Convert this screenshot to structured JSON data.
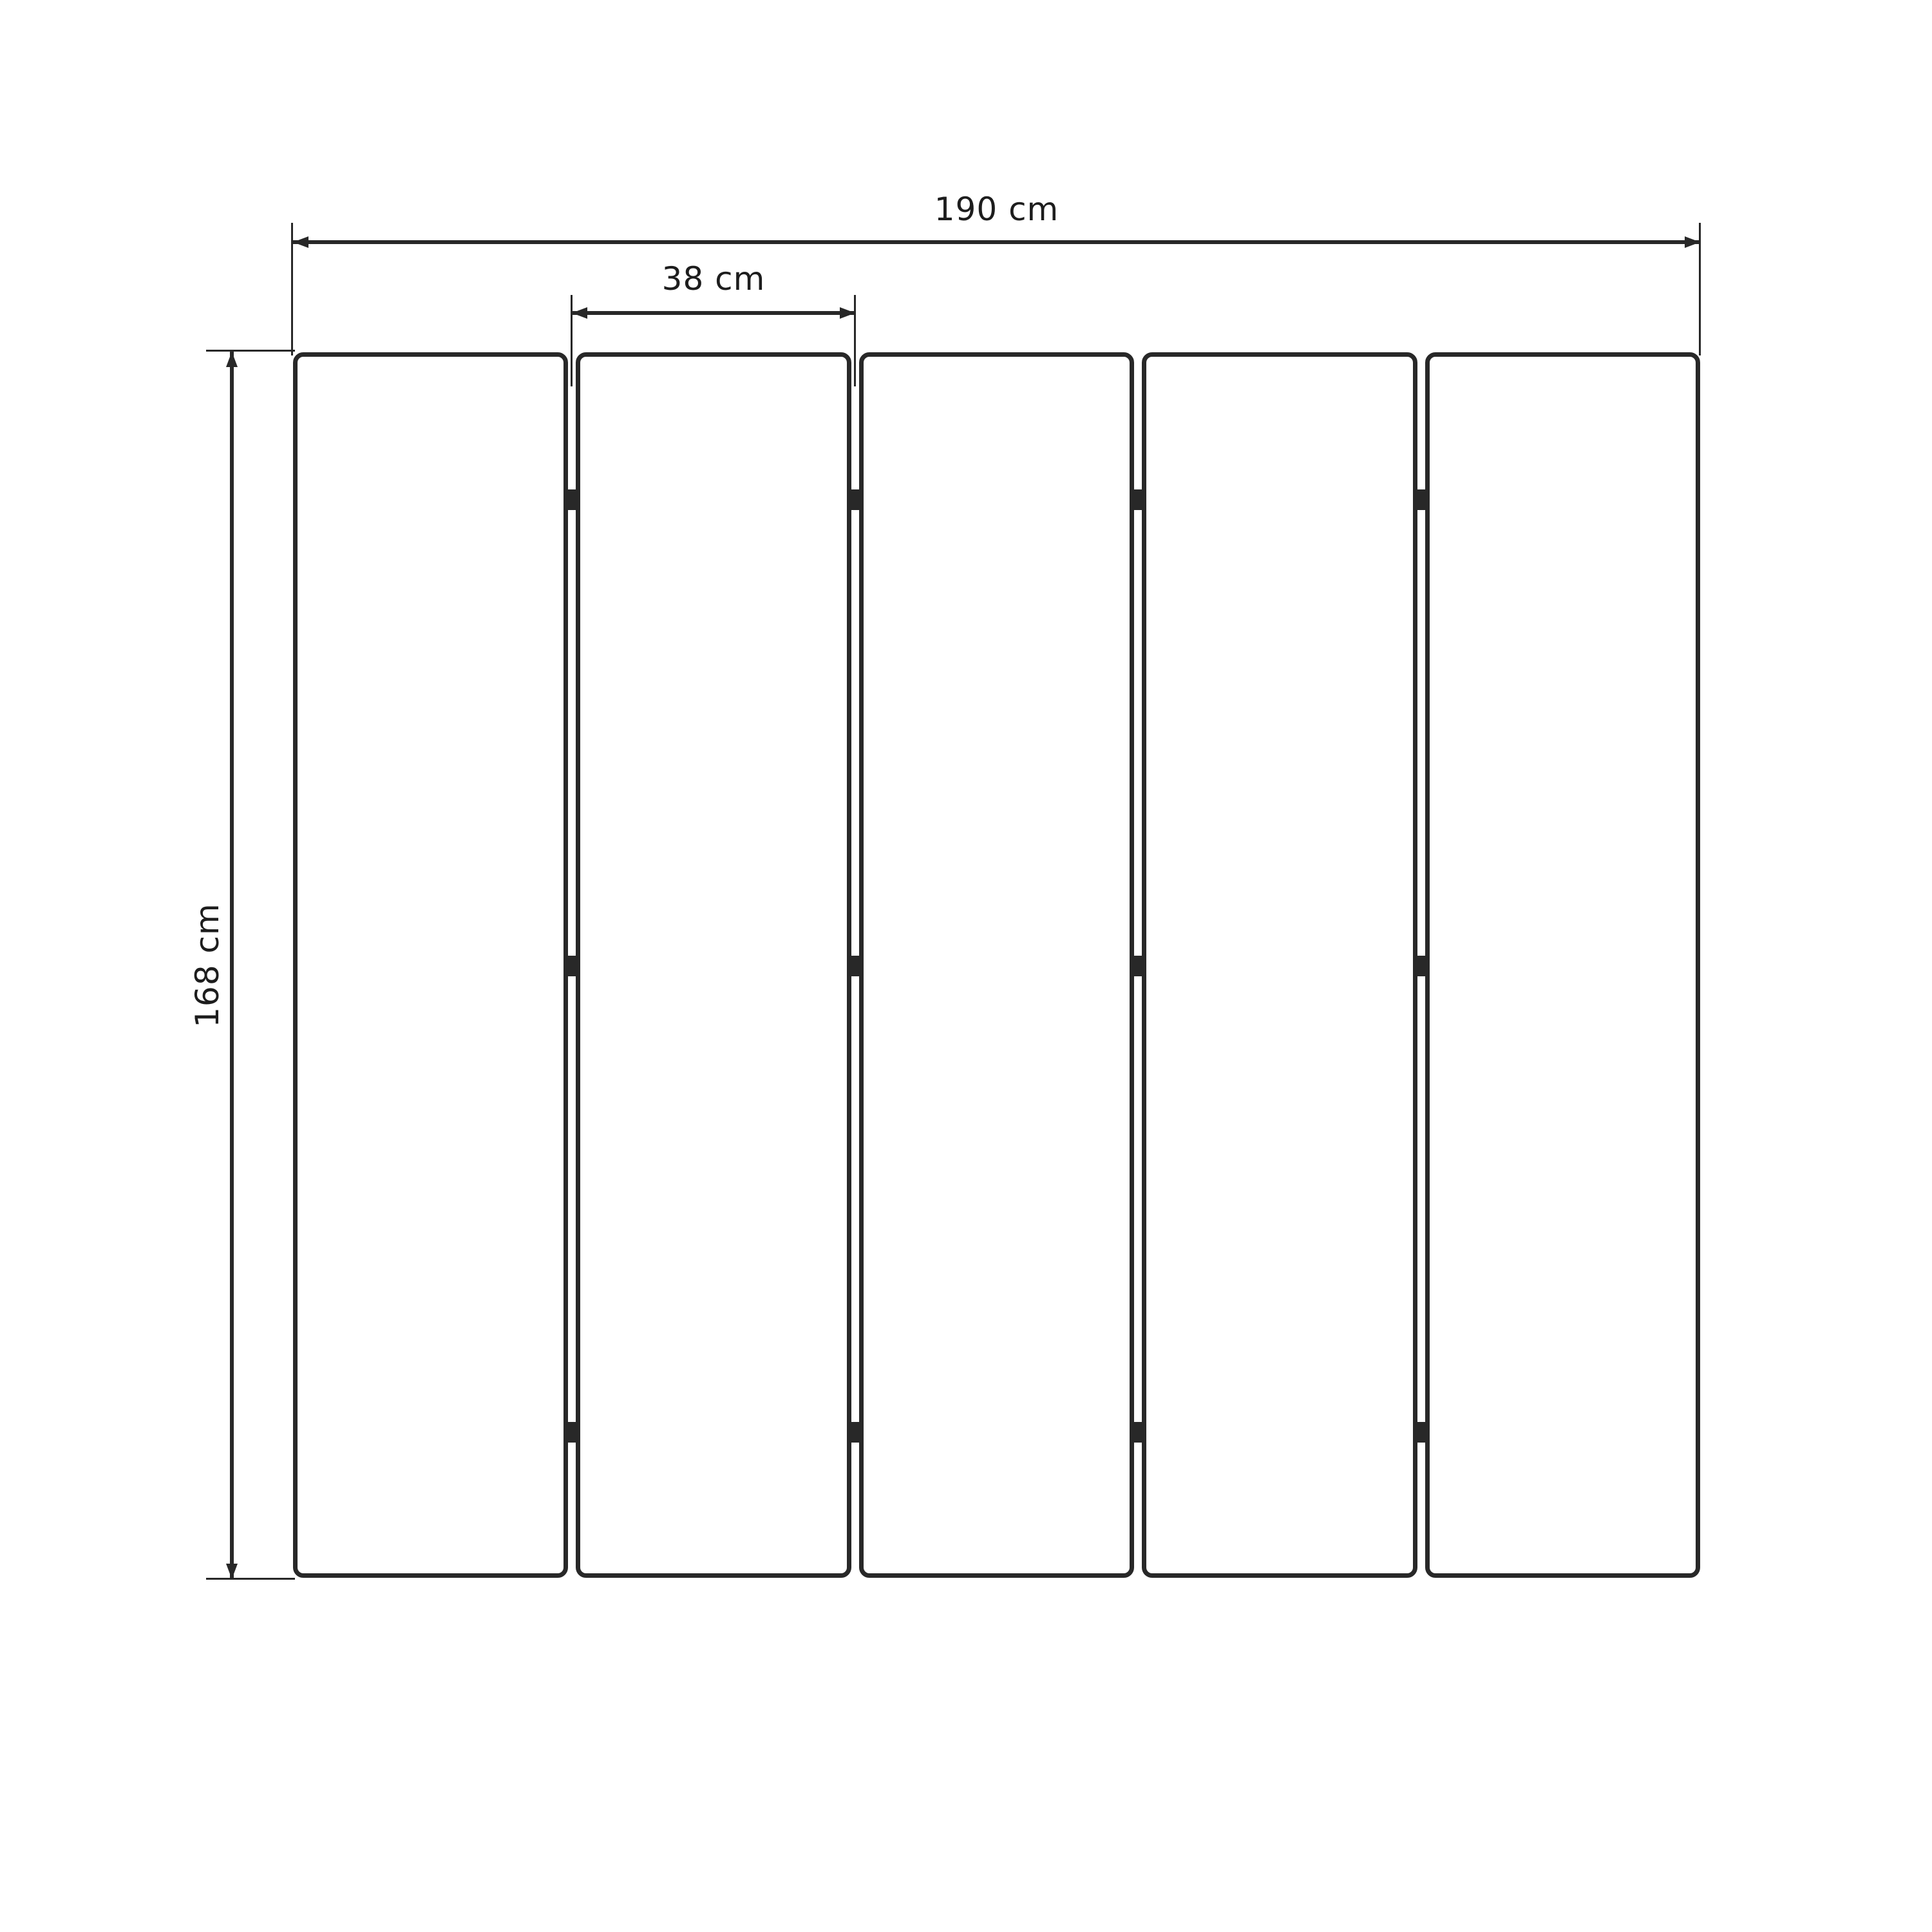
{
  "diagram": {
    "dimensions": {
      "total_width": {
        "label": "190 cm",
        "value": 190,
        "unit": "cm"
      },
      "panel_width": {
        "label": "38 cm",
        "value": 38,
        "unit": "cm"
      },
      "height": {
        "label": "168 cm",
        "value": 168,
        "unit": "cm"
      }
    },
    "panels": {
      "count": 5,
      "gaps": 4,
      "hinges_per_gap": 3
    }
  },
  "colors": {
    "background": "#ffffff",
    "stroke": "#282828",
    "text": "#1d1d1d"
  }
}
